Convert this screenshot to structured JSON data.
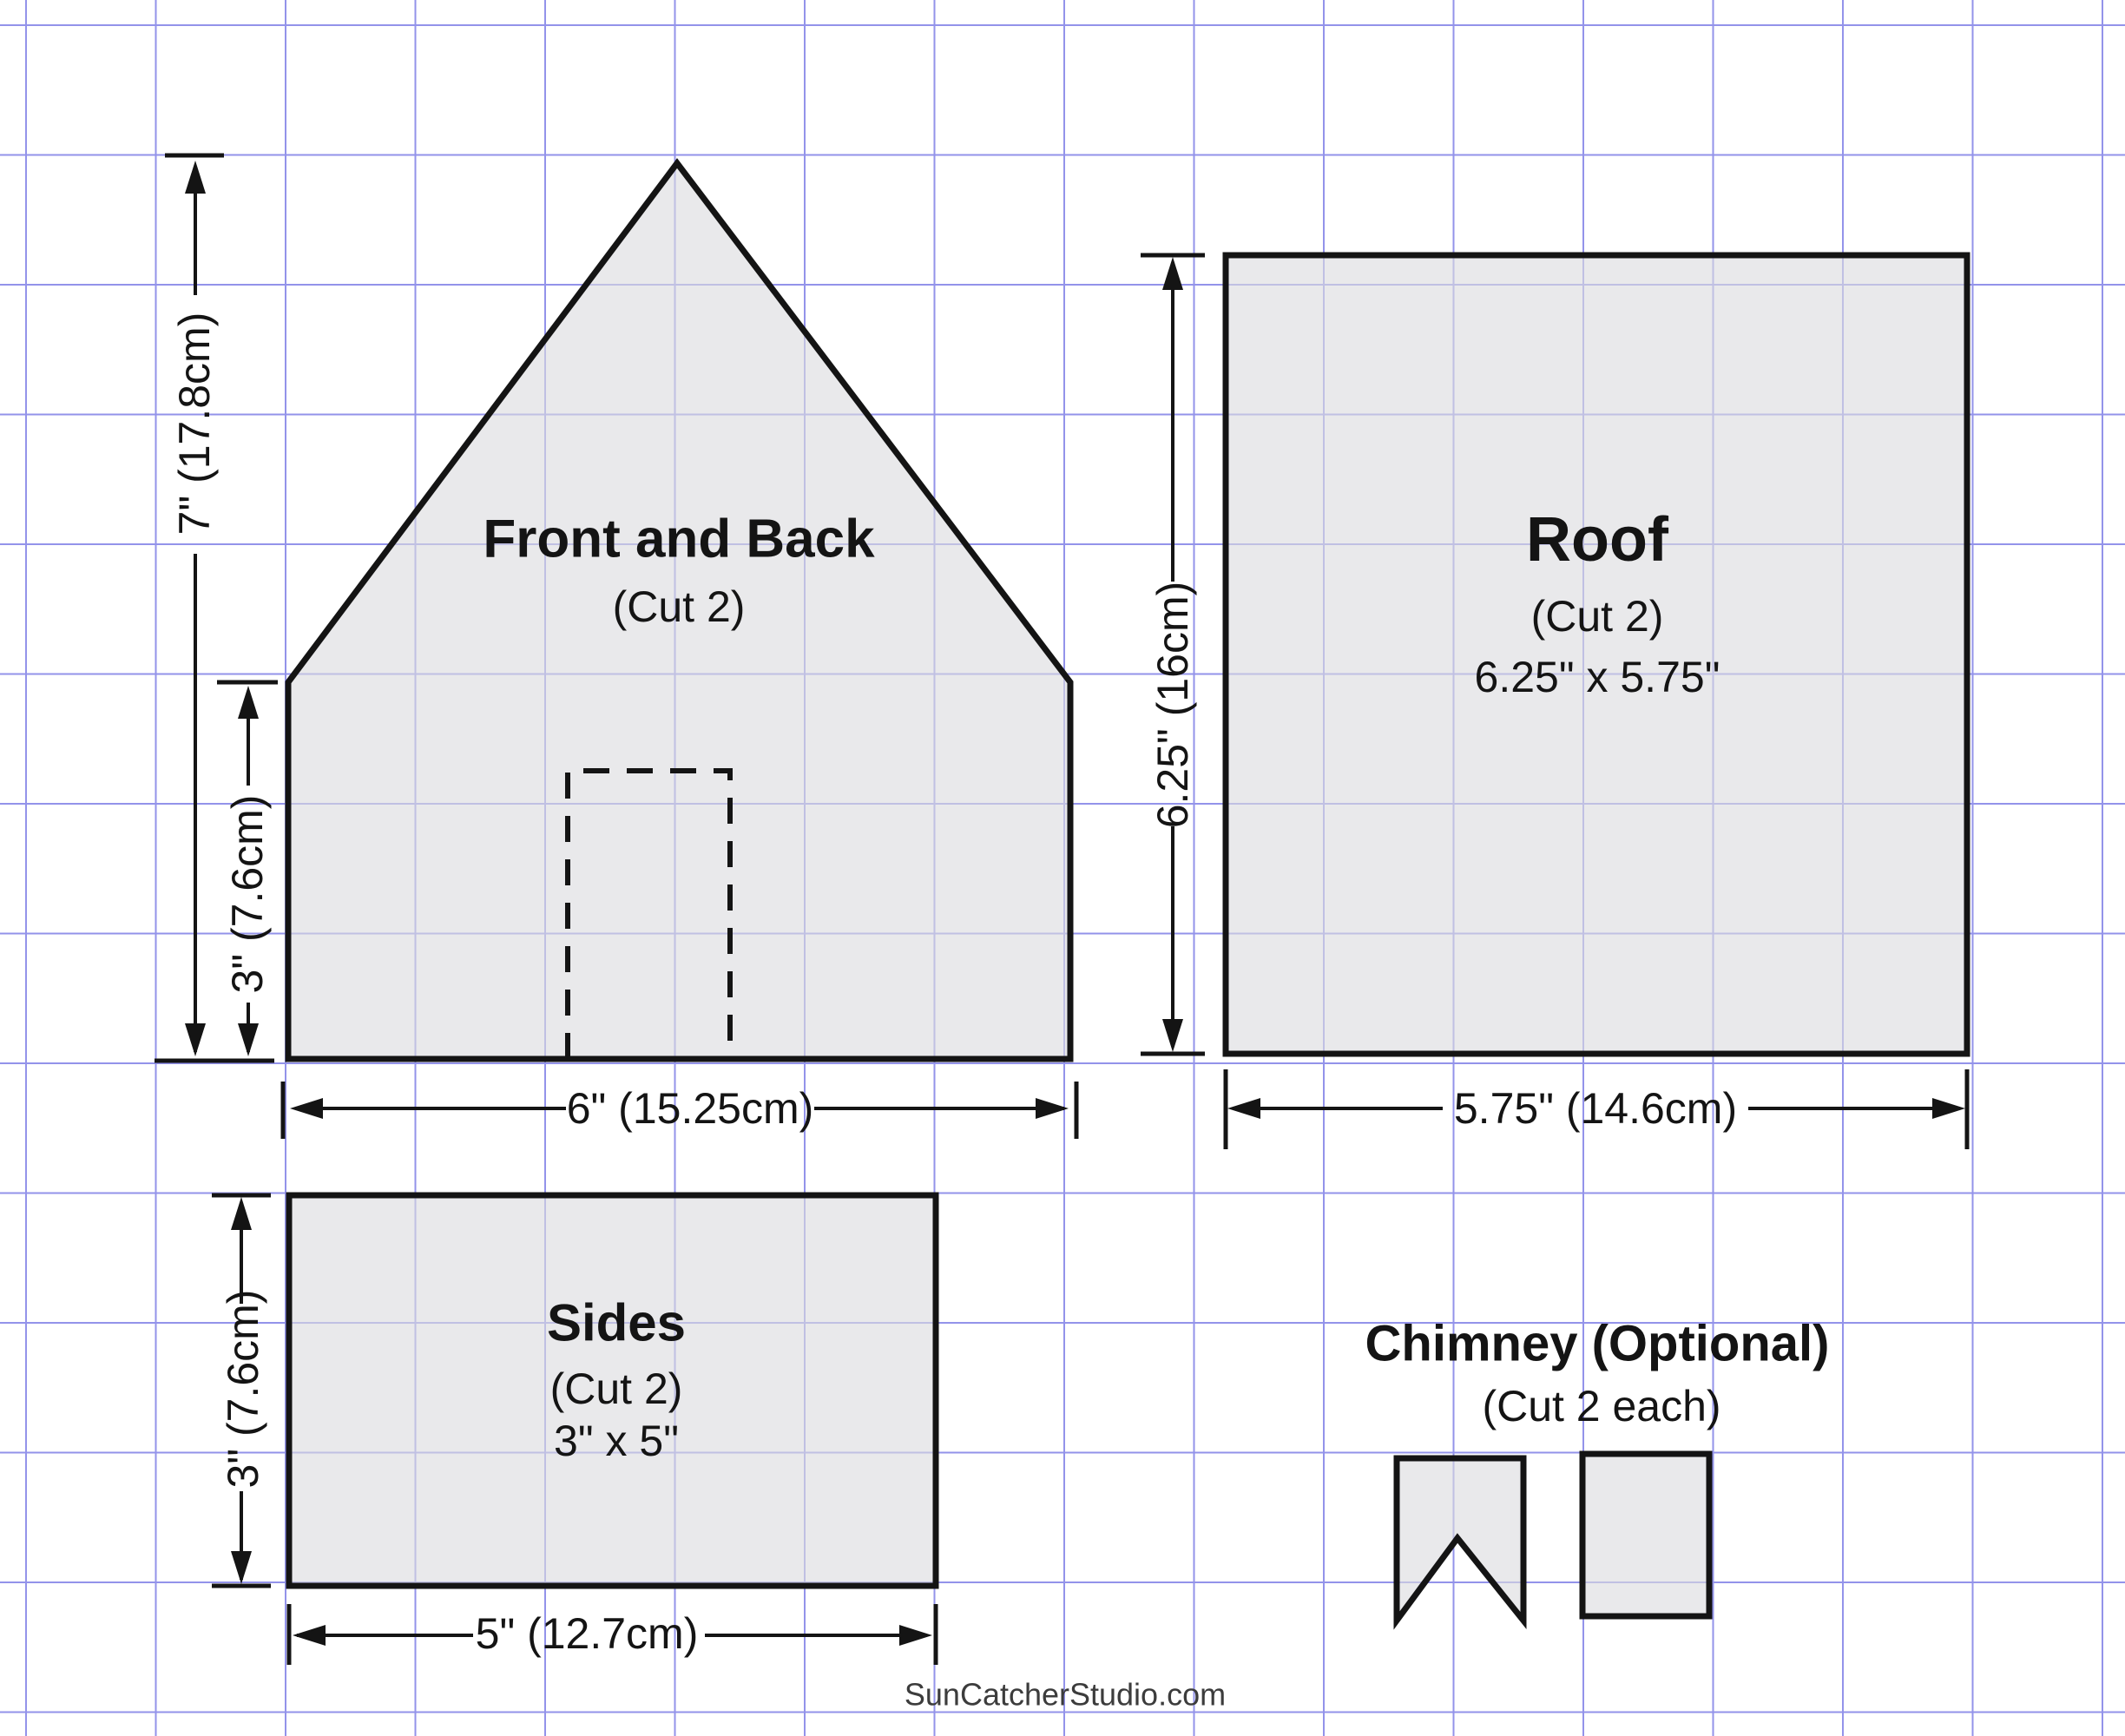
{
  "colors": {
    "background": "#ffffff",
    "grid_line": "#9393ea",
    "outline": "#141414",
    "piece_fill": "rgba(219,219,223,0.62)",
    "text": "#141414",
    "watermark": "#3c3c3c"
  },
  "pieces": {
    "front_back": {
      "title": "Front and Back",
      "cut": "(Cut 2)"
    },
    "roof": {
      "title": "Roof",
      "cut": "(Cut 2)",
      "size": "6.25\" x 5.75\""
    },
    "sides": {
      "title": "Sides",
      "cut": "(Cut 2)",
      "size": "3\" x 5\""
    },
    "chimney": {
      "title": "Chimney (Optional)",
      "cut": "(Cut 2 each)"
    }
  },
  "dimensions": {
    "front_height": "7\" (17.8cm)",
    "front_wall_height": "3\" (7.6cm)",
    "front_width": "6\" (15.25cm)",
    "roof_height": "6.25\" (16cm)",
    "roof_width": "5.75\" (14.6cm)",
    "side_height": "3\" (7.6cm)",
    "side_width": "5\" (12.7cm)"
  },
  "watermark": "SunCatcherStudio.com"
}
